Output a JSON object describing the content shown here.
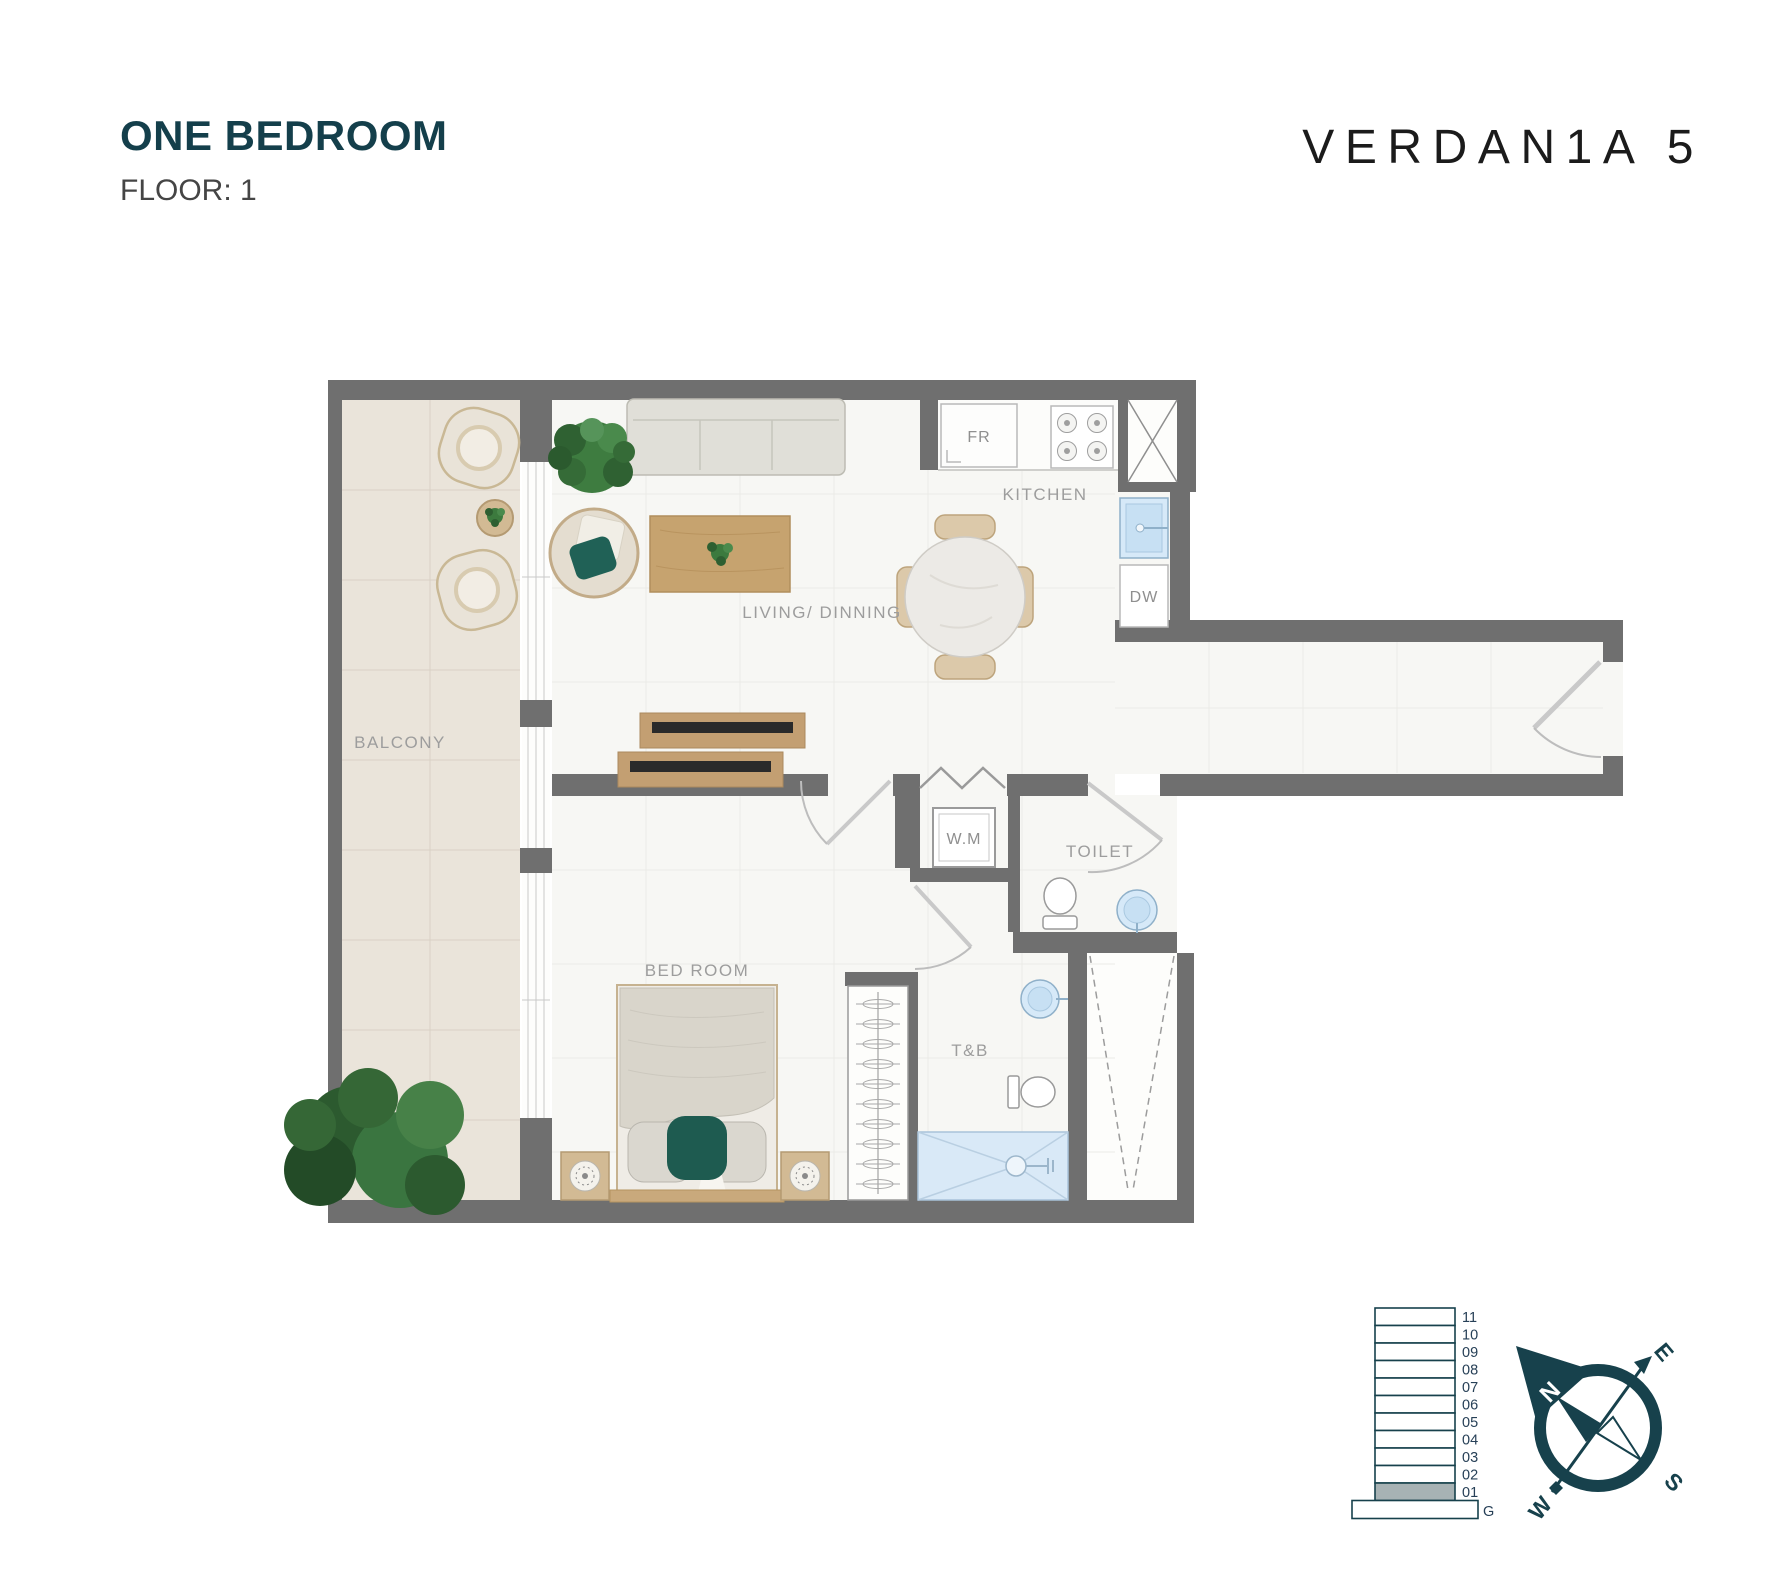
{
  "header": {
    "title": "ONE BEDROOM",
    "floor_label": "FLOOR: 1"
  },
  "brand": {
    "name": "VERDAN1A 5"
  },
  "plan": {
    "labels": {
      "balcony": "BALCONY",
      "living_dining": "LIVING/ DINNING",
      "kitchen": "KITCHEN",
      "bedroom": "BED ROOM",
      "toilet": "TOILET",
      "tb": "T&B",
      "wm": "W.M",
      "fridge": "FR",
      "dishwasher": "DW"
    },
    "colors": {
      "wall": "#6f6f6f",
      "balcony_floor": "#eae4da",
      "apartment_floor": "#f7f7f4",
      "wood": "#c6a36f",
      "accent_teal": "#1e5b50",
      "water_fixture": "#d6e9f8",
      "label_text": "#9d9d9d"
    }
  },
  "floor_indicator": {
    "floors": [
      "11",
      "10",
      "09",
      "08",
      "07",
      "06",
      "05",
      "04",
      "03",
      "02",
      "01"
    ],
    "ground": "G",
    "highlighted_floor": "01",
    "highlight_fill": "#a7b2b4",
    "line_color": "#17414c"
  },
  "compass": {
    "north": "N",
    "east": "E",
    "south": "S",
    "west": "W",
    "color": "#17414c"
  }
}
